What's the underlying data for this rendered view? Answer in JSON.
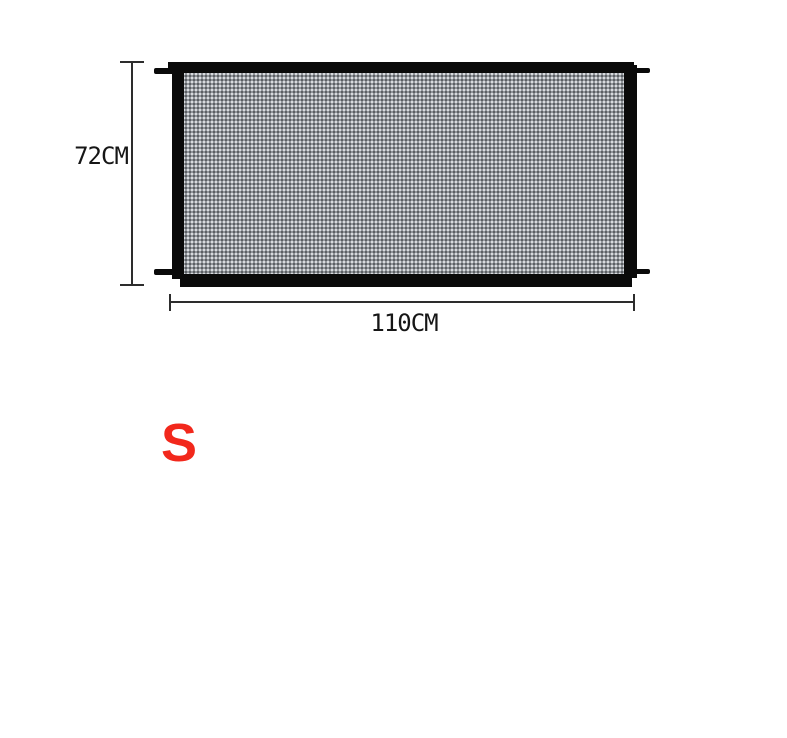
{
  "diagram": {
    "height_label": "72CM",
    "width_label": "110CM",
    "size_label": "S"
  },
  "colors": {
    "frame_black": "#0a0a0a",
    "mesh_gray": "#92969c",
    "mesh_highlight": "#e4e6e9",
    "mesh_shadow": "#54575b",
    "dimension_line": "#2d2d2d",
    "label_text": "#161616",
    "size_red": "#f2281c",
    "background": "#ffffff"
  },
  "icons": {
    "mesh_texture": "woven-mesh-pattern",
    "hook_tabs": "mounting-hook-tabs"
  }
}
